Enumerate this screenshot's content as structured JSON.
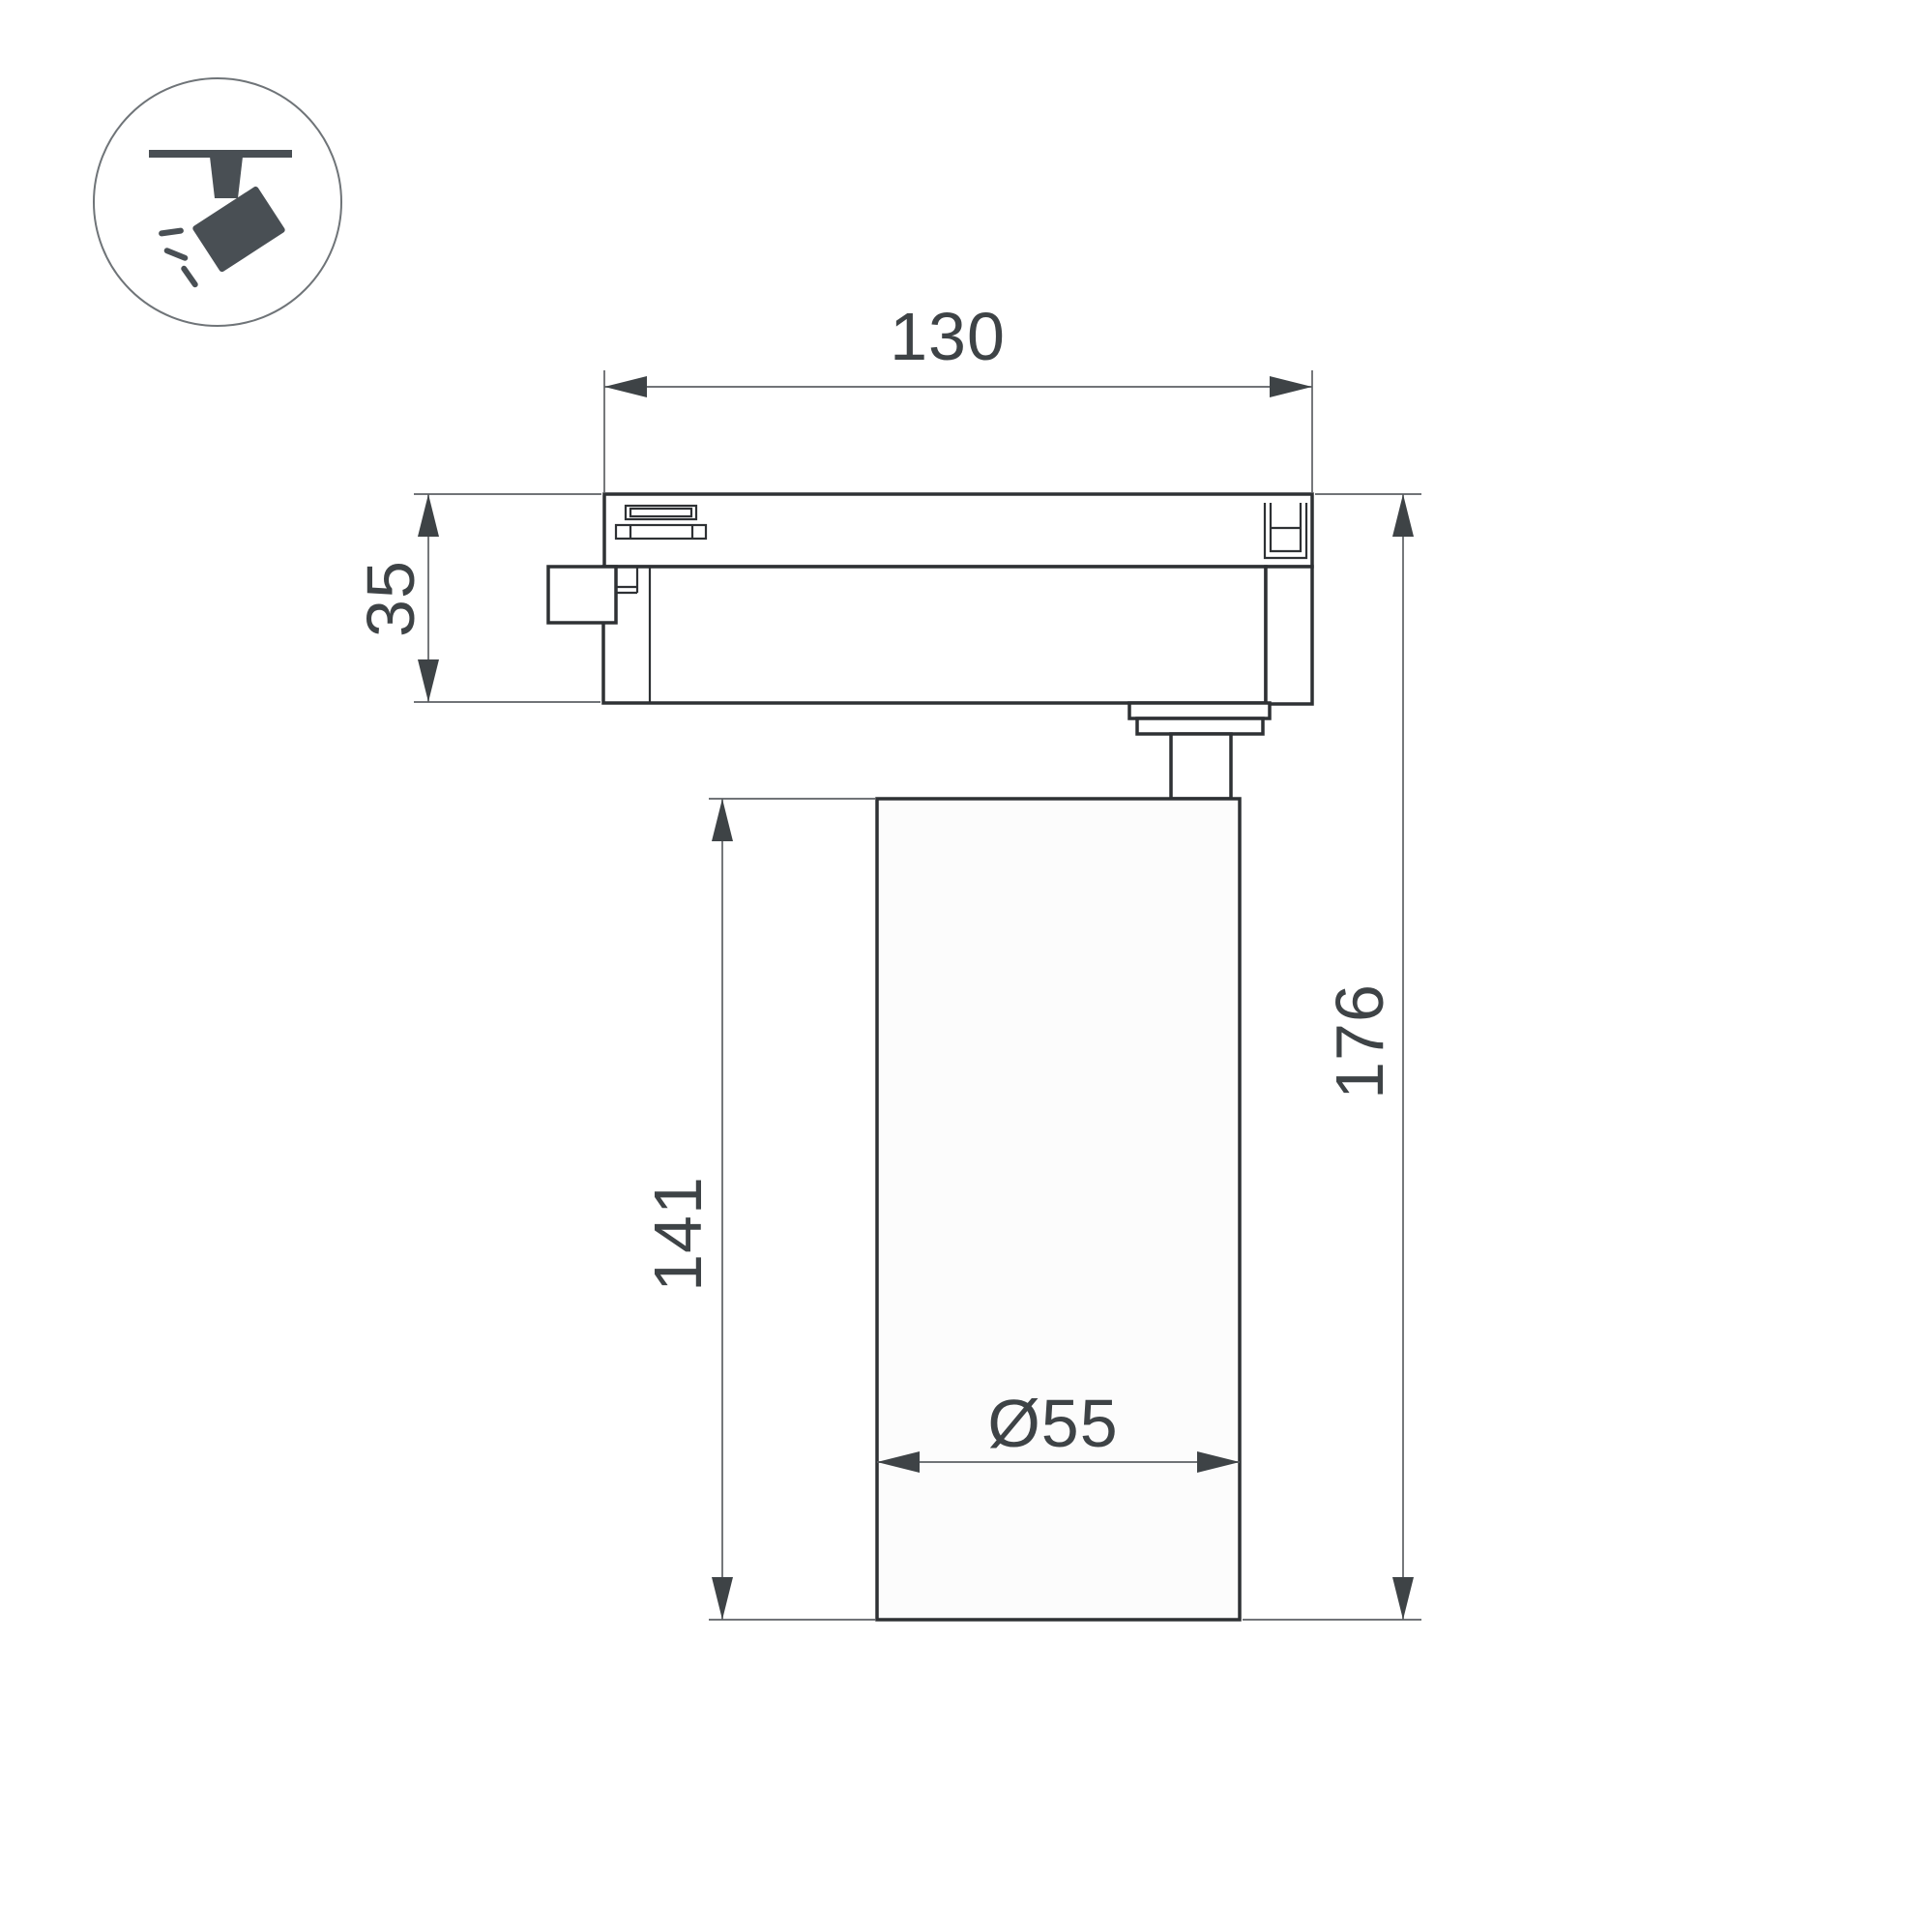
{
  "page": {
    "background": "#ffffff",
    "type": "technical-dimension-drawing",
    "subject": "track-mounted spotlight luminaire, side view"
  },
  "colors": {
    "outline": "#2e3134",
    "dimension_line": "#5d6164",
    "dimension_text": "#3e4346",
    "icon_glyph": "#494f54",
    "icon_circle_border": "#6f7478",
    "lamp_fill": "#fcfcfc"
  },
  "icon": {
    "name": "track-spotlight-pictogram",
    "description": "spotlight hanging from ceiling track with light rays"
  },
  "dimensions": {
    "width": {
      "label": "130"
    },
    "adapter_height": {
      "label": "35"
    },
    "body_height": {
      "label": "141"
    },
    "total_height": {
      "label": "176"
    },
    "diameter": {
      "label": "Ø55"
    }
  }
}
